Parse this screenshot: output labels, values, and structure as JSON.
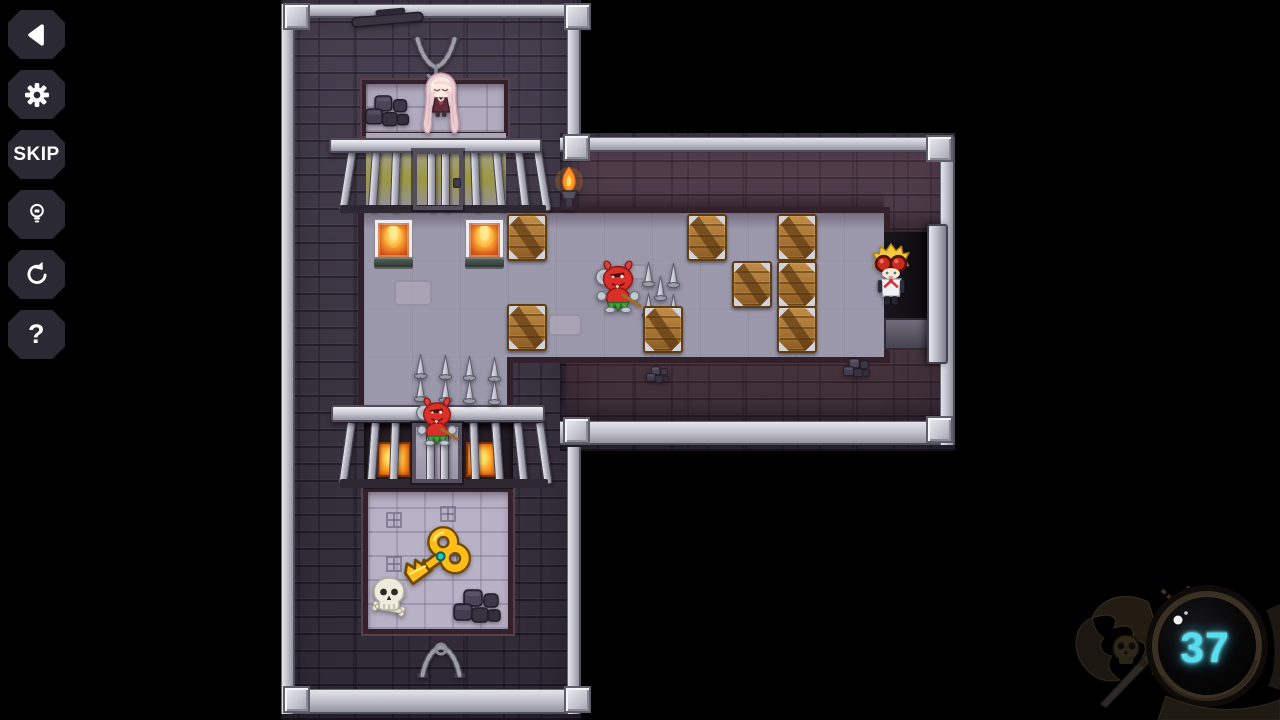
{
  "window": {
    "width": 1280,
    "height": 720,
    "background": "#000000"
  },
  "sidebar": {
    "buttons": [
      {
        "name": "back",
        "icon": "back-arrow",
        "label": ""
      },
      {
        "name": "settings",
        "icon": "gear",
        "label": ""
      },
      {
        "name": "skip",
        "icon": "",
        "label": "SKIP"
      },
      {
        "name": "hint",
        "icon": "lightbulb",
        "label": ""
      },
      {
        "name": "restart",
        "icon": "restart-arrow",
        "label": ""
      },
      {
        "name": "help",
        "icon": "",
        "label": "?"
      }
    ]
  },
  "hud": {
    "move_counter": {
      "value": "37",
      "color": "#56dff2"
    }
  },
  "level": {
    "gates": [
      {
        "name": "prison-gate-top",
        "beam": [
          329,
          138,
          213,
          15
        ],
        "lip": [
          340,
          205,
          206,
          8
        ],
        "frame": [
          413,
          150,
          50,
          60
        ],
        "latch": [
          453,
          178,
          8,
          10
        ],
        "bars_y": 150,
        "bars_h": 62,
        "bars": [
          [
            348,
            9
          ],
          [
            372,
            4
          ],
          [
            392,
            2
          ],
          [
            427,
            0
          ],
          [
            441,
            0
          ],
          [
            470,
            -2
          ],
          [
            492,
            -5
          ],
          [
            514,
            -7
          ],
          [
            533,
            -9
          ]
        ]
      },
      {
        "name": "prison-gate-bottom",
        "recess": [
          364,
          423,
          149,
          66
        ],
        "lava": [
          [
            377,
            442,
            34,
            35
          ],
          [
            466,
            442,
            31,
            35
          ]
        ],
        "column": [
          412,
          423,
          50,
          63
        ],
        "beam": [
          331,
          405,
          214,
          17
        ],
        "lip": [
          340,
          479,
          208,
          9
        ],
        "frame": [
          412,
          423,
          50,
          60
        ],
        "bars_y": 422,
        "bars_h": 63,
        "bars": [
          [
            347,
            8
          ],
          [
            371,
            4
          ],
          [
            391,
            2
          ],
          [
            426,
            0
          ],
          [
            440,
            0
          ],
          [
            469,
            -2
          ],
          [
            491,
            -4
          ],
          [
            513,
            -6
          ],
          [
            535,
            -8
          ]
        ]
      }
    ],
    "fire_plates": [
      [
        375,
        220,
        37,
        40
      ],
      [
        466,
        220,
        37,
        40
      ]
    ],
    "lava_tiles": [],
    "floor_patches": [
      [
        394,
        280,
        38,
        26
      ],
      [
        548,
        314,
        34,
        22
      ],
      [
        622,
        264,
        26,
        16
      ]
    ],
    "floor_squares": [
      [
        386,
        512,
        16,
        16
      ],
      [
        440,
        506,
        16,
        16
      ],
      [
        386,
        556,
        16,
        16
      ],
      [
        442,
        554,
        16,
        16
      ]
    ],
    "spikes": [
      [
        413,
        353
      ],
      [
        438,
        354
      ],
      [
        462,
        355
      ],
      [
        487,
        356
      ],
      [
        413,
        376
      ],
      [
        438,
        377
      ],
      [
        462,
        378
      ],
      [
        487,
        379
      ],
      [
        641,
        261
      ],
      [
        666,
        262
      ],
      [
        653,
        275
      ],
      [
        641,
        292
      ],
      [
        666,
        293
      ]
    ],
    "crates": [
      [
        507,
        214
      ],
      [
        687,
        214
      ],
      [
        777,
        214
      ],
      [
        732,
        261
      ],
      [
        777,
        261
      ],
      [
        507,
        304
      ],
      [
        643,
        306
      ],
      [
        777,
        306
      ]
    ],
    "crate_size": [
      40,
      47
    ],
    "sprites": [
      {
        "name": "chain-shackle-top",
        "symbol": "chain",
        "x": 410,
        "y": 36,
        "w": 52,
        "h": 46,
        "interactable": false
      },
      {
        "name": "chain-shackle-bottom",
        "symbol": "chainb",
        "x": 415,
        "y": 636,
        "w": 52,
        "h": 42,
        "interactable": false
      },
      {
        "name": "rubble-rocks-cell",
        "symbol": "rocks",
        "x": 362,
        "y": 84,
        "w": 52,
        "h": 48,
        "interactable": false
      },
      {
        "name": "fallen-beam-top-wall",
        "symbol": "beam",
        "x": 350,
        "y": 6,
        "w": 76,
        "h": 24,
        "interactable": false
      },
      {
        "name": "rubble-rocks-key-room",
        "symbol": "rocks",
        "x": 450,
        "y": 578,
        "w": 56,
        "h": 50,
        "interactable": false
      },
      {
        "name": "rubble-corridor-wall-left",
        "symbol": "rocks",
        "x": 638,
        "y": 361,
        "w": 40,
        "h": 24,
        "interactable": false
      },
      {
        "name": "rubble-corridor-wall-right",
        "symbol": "rocks",
        "x": 832,
        "y": 352,
        "w": 50,
        "h": 28,
        "interactable": false
      },
      {
        "name": "wall-torch",
        "symbol": "torch",
        "x": 554,
        "y": 165,
        "w": 30,
        "h": 52,
        "interactable": false
      },
      {
        "name": "skull-bones",
        "symbol": "skull",
        "x": 369,
        "y": 576,
        "w": 42,
        "h": 44,
        "interactable": false
      },
      {
        "name": "golden-key",
        "symbol": "key",
        "x": 402,
        "y": 524,
        "w": 70,
        "h": 70,
        "interactable": true
      },
      {
        "name": "prisoner-girl",
        "symbol": "girl",
        "x": 421,
        "y": 72,
        "w": 40,
        "h": 62,
        "interactable": true
      },
      {
        "name": "enemy-devil-corridor",
        "symbol": "devil",
        "x": 593,
        "y": 258,
        "w": 50,
        "h": 54,
        "interactable": true
      },
      {
        "name": "enemy-devil-gate",
        "symbol": "devil",
        "x": 414,
        "y": 394,
        "w": 46,
        "h": 52,
        "interactable": true
      },
      {
        "name": "player-character",
        "symbol": "player",
        "x": 872,
        "y": 243,
        "w": 38,
        "h": 63,
        "interactable": true
      }
    ]
  }
}
